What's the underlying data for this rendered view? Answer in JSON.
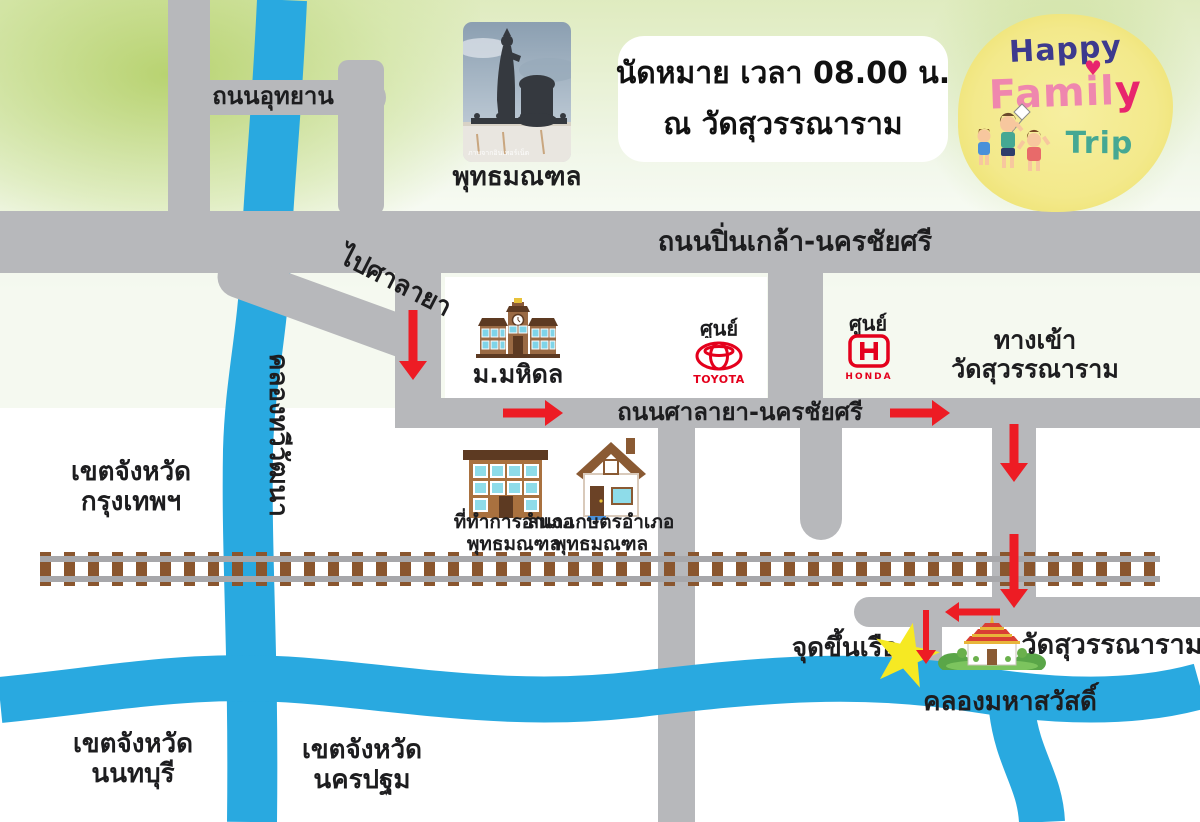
{
  "title_box": {
    "line1": "นัดหมาย เวลา 08.00 น.",
    "line2": "ณ วัดสุวรรณาราม"
  },
  "logo": {
    "word1": "Happy",
    "word2_a": "Famil",
    "word2_b": "y",
    "heart": "♥",
    "word3": "Trip"
  },
  "landmark_photo": {
    "caption": "พุทธมณฑล",
    "watermark": "ภาพจากอินเทอร์เน็ต"
  },
  "roads": {
    "uthayan": "ถนนอุทยาน",
    "pinklao": "ถนนปิ่นเกล้า-นครชัยศรี",
    "to_salaya": "ไปศาลายา",
    "salaya": "ถนนศาลายา-นครชัยศรี",
    "entrance_line1": "ทางเข้า",
    "entrance_line2": "วัดสุวรรณาราม"
  },
  "waterways": {
    "thawi_watthana": "คลองทวีวัฒนา",
    "mahasawat": "คลองมหาสวัสดิ์"
  },
  "places": {
    "mahidol": "ม.มหิดล",
    "toyota_center": "ศูนย์",
    "toyota_wordmark": "TOYOTA",
    "honda_center": "ศูนย์",
    "honda_wordmark": "HONDA",
    "district_office_line1": "ที่ทำการอำเภอ",
    "district_office_line2": "พุทธมณฑล",
    "agri_office_line1": "สนง.เกษตรอำเภอ",
    "agri_office_line2": "พุทธมณฑล",
    "boat_point": "จุดขึ้นเรือ",
    "temple": "วัดสุวรรณาราม"
  },
  "regions": {
    "bangkok_line1": "เขตจังหวัด",
    "bangkok_line2": "กรุงเทพฯ",
    "nonthaburi_line1": "เขตจังหวัด",
    "nonthaburi_line2": "นนทบุรี",
    "nakhonpathom_line1": "เขตจังหวัด",
    "nakhonpathom_line2": "นครปฐม"
  },
  "colors": {
    "road": "#b7b8bb",
    "water": "#29a9e0",
    "arrow_red": "#ed1c24",
    "star_yellow": "#f6e923",
    "rail_sleeper": "#8a562e",
    "rail": "#a7a7aa",
    "toyota_red": "#e4001c",
    "honda_red": "#e4001c",
    "logo_happy": "#3d3a8e",
    "logo_family": "#ef87ae",
    "logo_family_y": "#e8256d",
    "logo_trip": "#45a893"
  }
}
